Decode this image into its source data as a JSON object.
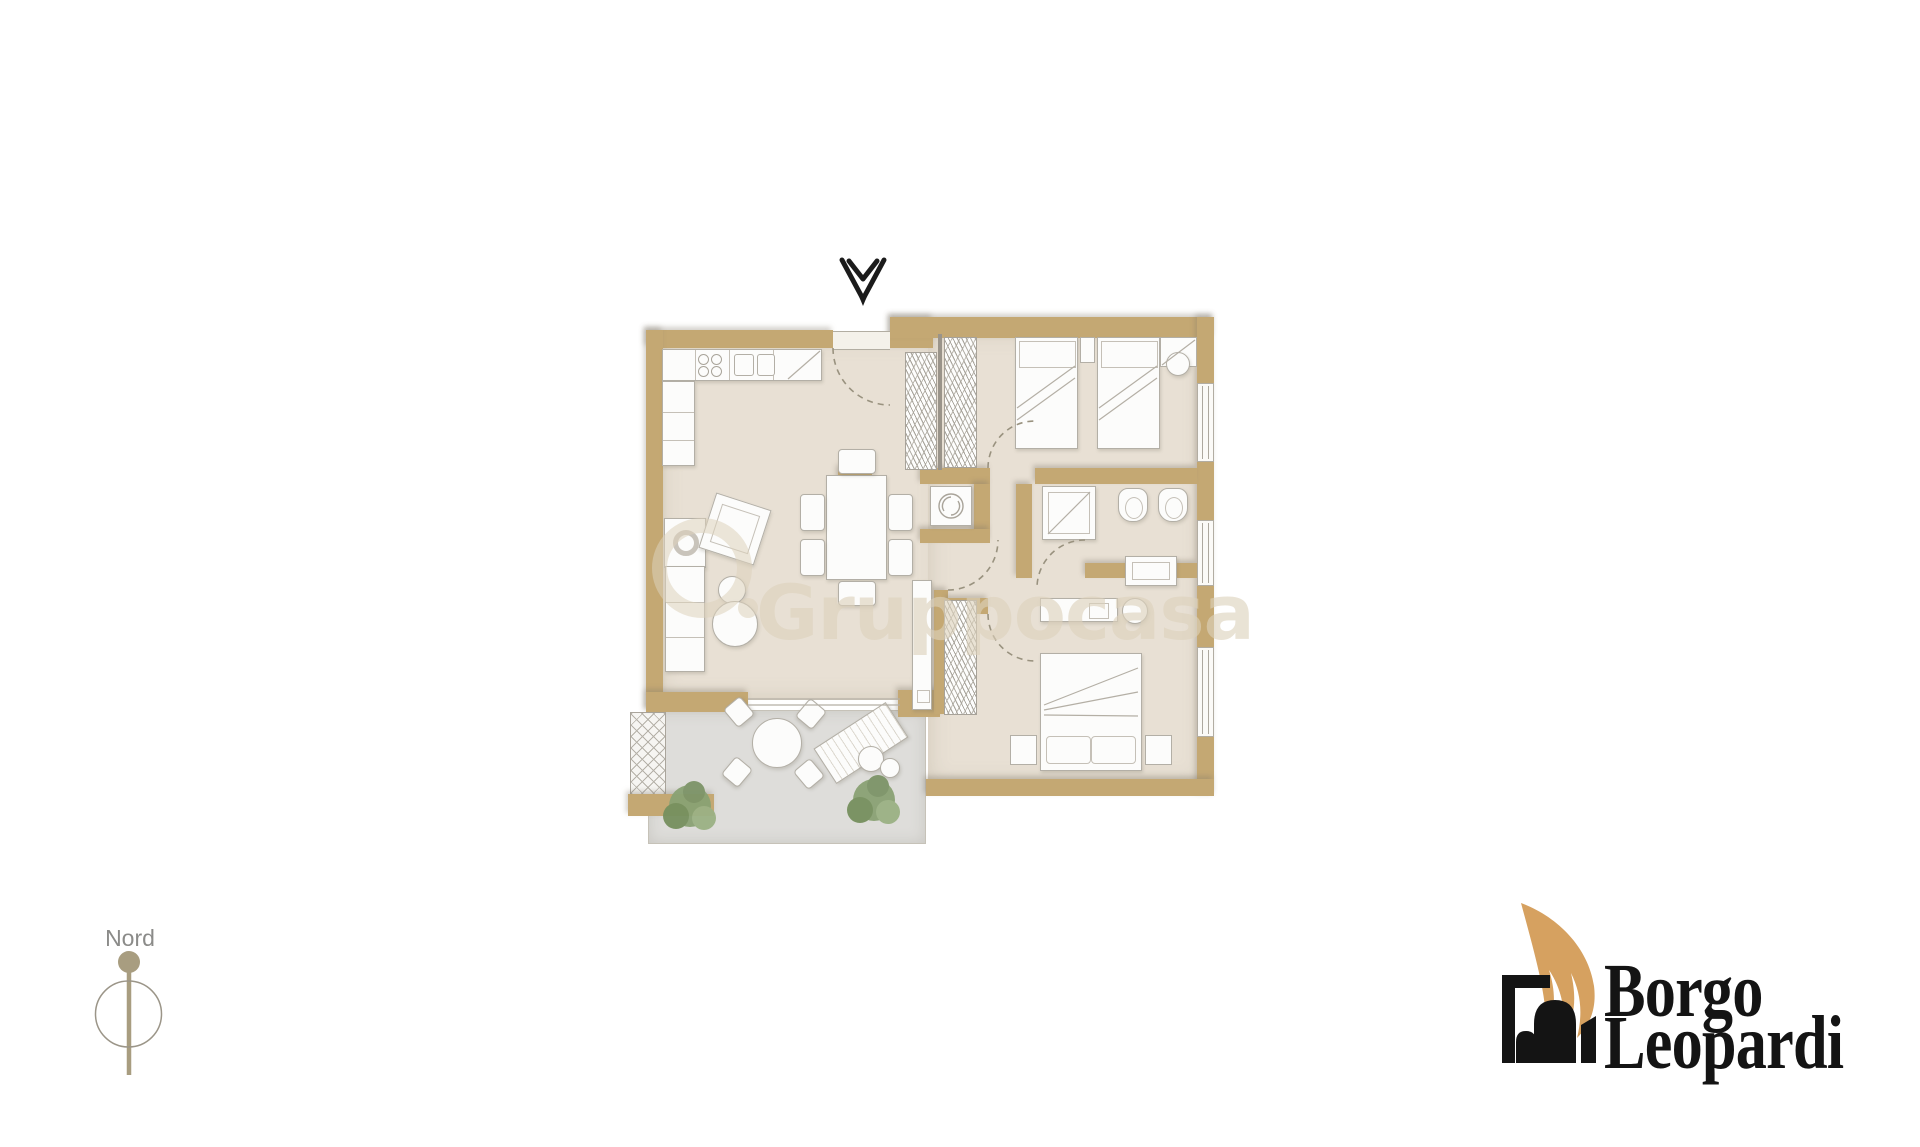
{
  "compass": {
    "label": "Nord",
    "icon": "north-needle-icon"
  },
  "entrance": {
    "icon": "entrance-direction-arrow-icon"
  },
  "watermark": {
    "text": "Gruppocasa",
    "icon": "gruppocasa-ring-icon"
  },
  "brand": {
    "line1": "Borgo",
    "line2": "Leopardi",
    "icon": "arch-and-feather-icon"
  },
  "colors": {
    "wall": "#c4a873",
    "floor": "#e8e0d4",
    "terrace_floor": "#dedddб",
    "furniture_outline": "#b3afa6",
    "watermark": "#ddd2bc",
    "logo_text": "#141414",
    "logo_feather": "#d6a160",
    "compass_needle": "#a89d80",
    "compass_text": "#8b8b89",
    "plant_green": "#8aa274"
  },
  "floor_plan": {
    "features": [
      "entrance-door-with-swing-arc",
      "kitchen-counter-hob-sink-corner-unit",
      "dining-table-with-six-chairs",
      "corner-sofa-armchair-and-poufs",
      "hallway-wardrobe",
      "laundry-closet-washing-machine",
      "twin-bedroom-two-single-beds",
      "bathroom-shower-toilet-bidet",
      "master-bedroom-double-bed-desk",
      "wardrobe-columns",
      "terrace-round-table-sunbed-plants",
      "three-windows-right-wall"
    ]
  }
}
